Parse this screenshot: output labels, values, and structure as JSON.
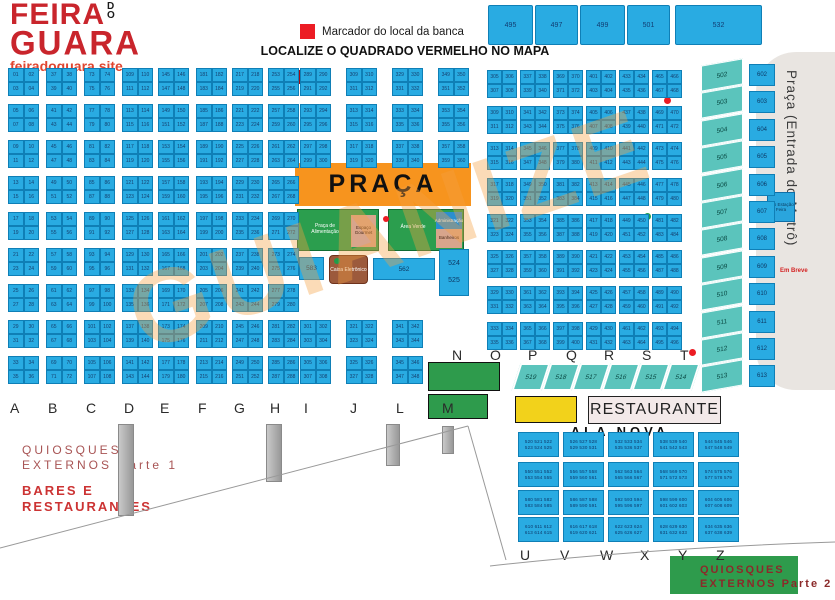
{
  "colors": {
    "cell_blue": "#29ABE2",
    "teal": "#5BC4BC",
    "orange": "#F7941E",
    "green": "#2B9E4E",
    "yellow": "#F2D21B",
    "red": "#EC1C24",
    "logo_red": "#C9252C",
    "dark_red_text": "#A85454"
  },
  "logo": {
    "line1": "FEIRA",
    "do": "DO",
    "line2": "GUARA",
    "site": "feiradoguara.site"
  },
  "legend": {
    "marker_label": "Marcador do local da banca",
    "headline": "LOCALIZE O QUADRADO VERMELHO NO MAPA"
  },
  "watermark": {
    "text": "GUIANIZE"
  },
  "top_row": {
    "cells": [
      "495",
      "497",
      "499",
      "501",
      "532"
    ]
  },
  "main_grid": {
    "letters": [
      "A",
      "B",
      "C",
      "D",
      "E",
      "F",
      "G",
      "H",
      "I",
      "J",
      "L",
      "M"
    ],
    "start_number": 1
  },
  "right_grid": {
    "start_number": 305,
    "columns": 6,
    "blocks": 8
  },
  "praca": {
    "title": "PRAÇA",
    "green_left": "Praça de Alimentação",
    "green_left_inset": "Espaço Gourmet",
    "green_right": "Área Verde",
    "green_right_inset_top": "Administração",
    "green_right_inset_bottom": "Banheiros",
    "cell_a": "583",
    "atm": "Caixa Eletrônico",
    "cell_b": "562",
    "pair": [
      "524",
      "525"
    ]
  },
  "letters_nt": [
    "N",
    "O",
    "P",
    "Q",
    "R",
    "S",
    "T"
  ],
  "diagonal_row": [
    "519",
    "518",
    "517",
    "516",
    "515",
    "514"
  ],
  "slant_column": [
    "502",
    "503",
    "504",
    "505",
    "506",
    "507",
    "508",
    "509",
    "510",
    "511",
    "512",
    "513"
  ],
  "blue_column": [
    "602",
    "603",
    "604",
    "605",
    "606",
    "607",
    "608",
    "609",
    "610",
    "611",
    "612",
    "613"
  ],
  "metro": {
    "label": "Praça (Entrada do Metrô)",
    "em_breve": "Em Breve",
    "substation": "Sub Estação Feira"
  },
  "south": {
    "restaurante": "RESTAURANTE",
    "ala_nova": "ALA NOVA",
    "letters_uz": [
      "U",
      "V",
      "W",
      "X",
      "Y",
      "Z"
    ],
    "ala_start": 520,
    "quiosques2_line1": "QUIOSQUES",
    "quiosques2_line2": "EXTERNOS Parte 2"
  },
  "southwest": {
    "q1_line1": "QUIOSQUES",
    "q1_line2": "EXTERNOS Parte 1",
    "bares_line1": "BARES E",
    "bares_line2": "RESTAURANTES"
  }
}
